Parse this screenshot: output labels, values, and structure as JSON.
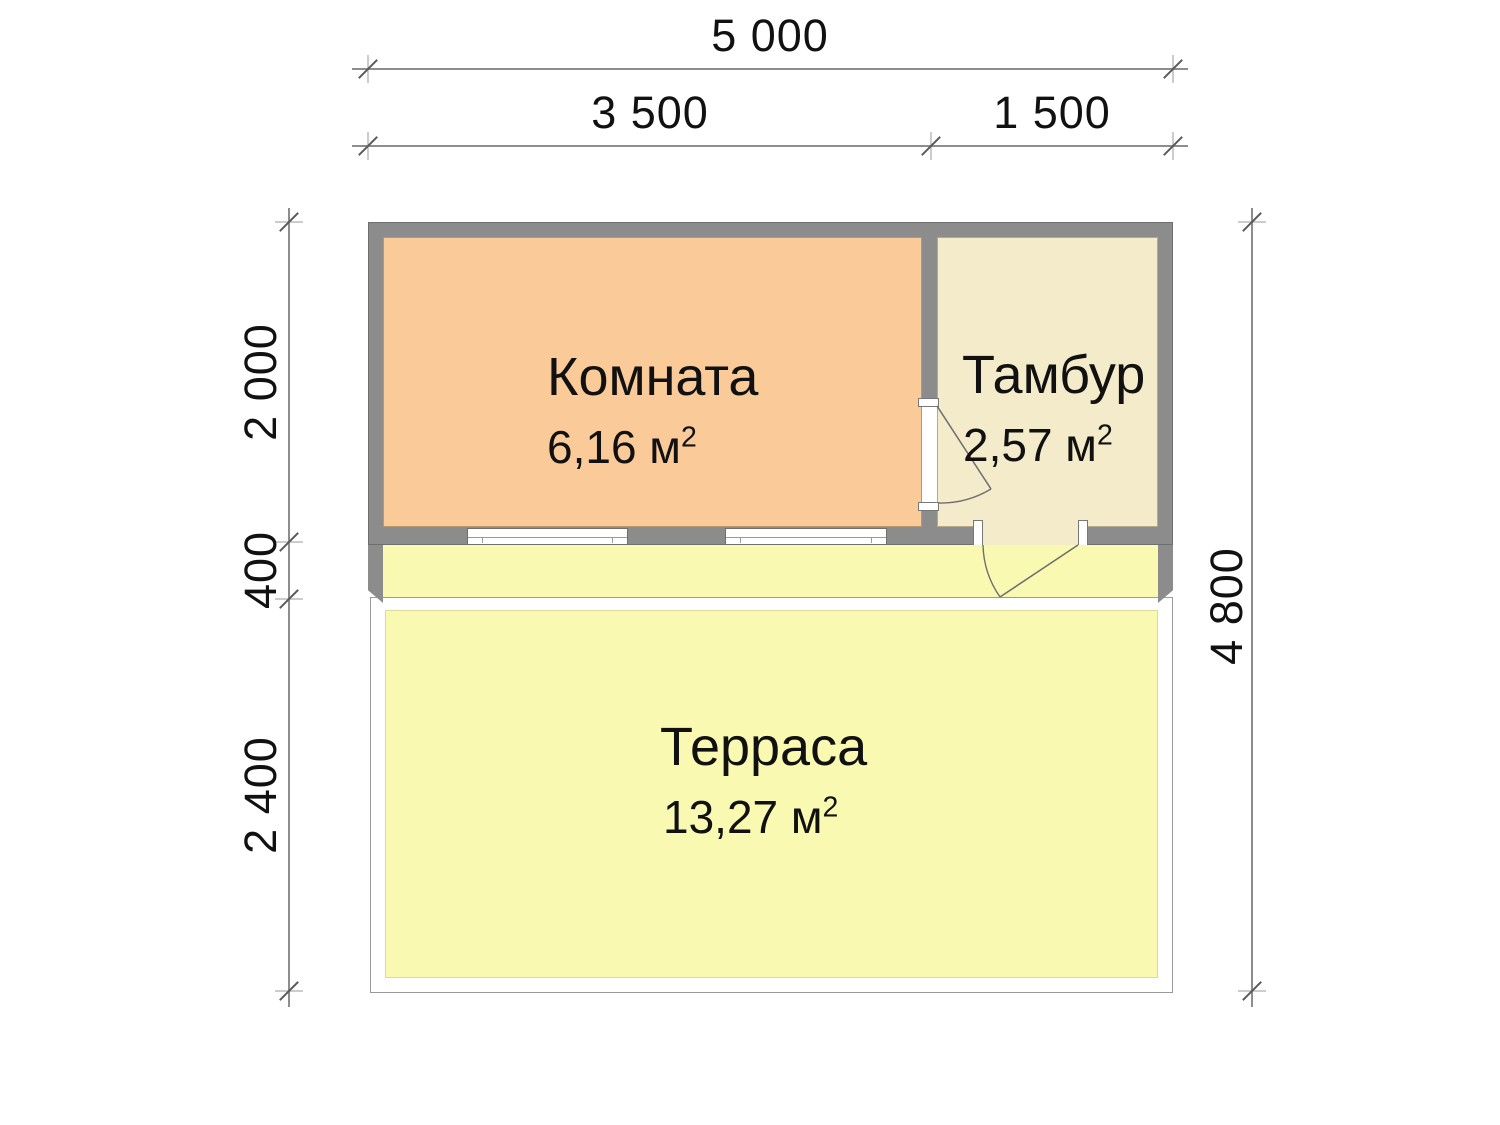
{
  "rooms": [
    {
      "id": "komnata",
      "name": "Комната",
      "area": "6,16 м",
      "area_sup": "2"
    },
    {
      "id": "tambur",
      "name": "Тамбур",
      "area": "2,57 м",
      "area_sup": "2"
    },
    {
      "id": "terrasa",
      "name": "Терраса",
      "area": "13,27 м",
      "area_sup": "2"
    }
  ],
  "dimensions": {
    "top_total": "5 000",
    "top_left_span": "3 500",
    "top_right_span": "1 500",
    "left_upper": "2 000",
    "left_step": "400",
    "left_lower": "2 400",
    "right_total": "4 800"
  },
  "colors": {
    "wall": "#8c8c8c",
    "room_fill": "#faca99",
    "vestibule_fill": "#f4ebca",
    "terrace_fill": "#faf9b2",
    "dimension_line": "#8d8d8d",
    "text": "#111111"
  }
}
